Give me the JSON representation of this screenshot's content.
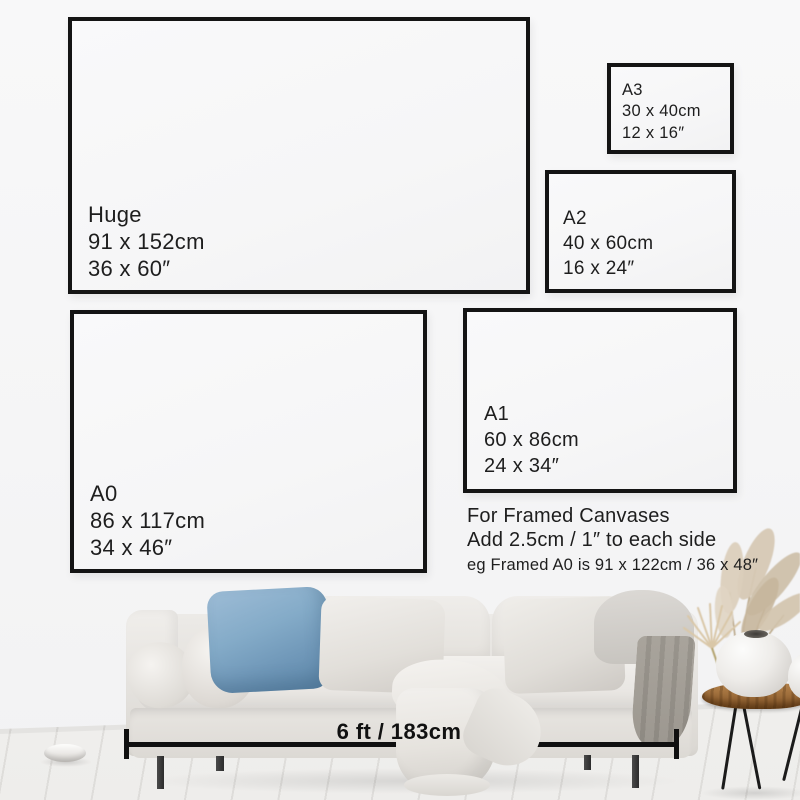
{
  "page": {
    "type": "canvas-size-guide-infographic"
  },
  "sizes": [
    {
      "name": "Huge",
      "cm": "91 x 152cm",
      "inches": "36 x 60″"
    },
    {
      "name": "A3",
      "cm": "30 x 40cm",
      "inches": "12 x 16″"
    },
    {
      "name": "A2",
      "cm": "40 x 60cm",
      "inches": "16 x 24″"
    },
    {
      "name": "A1",
      "cm": "60 x 86cm",
      "inches": "24 x 34″"
    },
    {
      "name": "A0",
      "cm": "86 x 117cm",
      "inches": "34 x 46″"
    }
  ],
  "framed_note": {
    "title": "For Framed Canvases",
    "line1": "Add 2.5cm / 1″ to each side",
    "line2": "eg Framed A0 is 91 x 122cm / 36 x 48″"
  },
  "measurement": {
    "label": "6 ft / 183cm"
  },
  "colors": {
    "frame_border": "#141414",
    "label_text": "#1e1e1e",
    "wall": "#f6f6f7",
    "blue_pillow": "#7ba3c4",
    "sofa_fabric": "#e9e6e2",
    "wood_table": "#9a6a38",
    "pampas": "#d3c3ac"
  }
}
